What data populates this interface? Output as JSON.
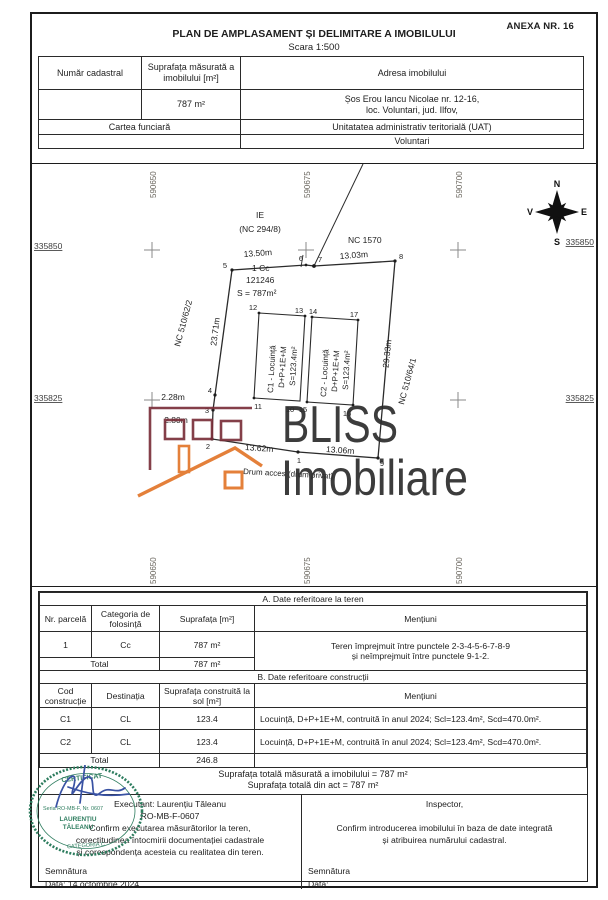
{
  "doc": {
    "annex": "ANEXA NR. 16",
    "title": "PLAN DE AMPLASAMENT ȘI DELIMITARE A IMOBILULUI",
    "scale": "Scara 1:500"
  },
  "header_table": {
    "numar_cadastral_label": "Număr cadastral",
    "suprafata_label": "Suprafața măsurată a imobilului [m²]",
    "adresa_label": "Adresa imobilului",
    "suprafata_value": "787 m²",
    "adresa_line1": "Șos Erou Iancu Nicolae nr. 12-16,",
    "adresa_line2": "loc. Voluntari, jud. Ilfov,",
    "cartea_funciara_label": "Cartea funciară",
    "uat_label": "Unitatatea administrativ teritorială (UAT)",
    "uat_value": "Voluntari"
  },
  "plan": {
    "grid_x_labels": {
      "g1": "590650",
      "g2": "590675",
      "g3": "590700"
    },
    "grid_y_labels": {
      "left_top": "335850",
      "left_bottom": "335825",
      "right_top": "335850",
      "right_bottom": "335825"
    },
    "compass": {
      "n": "N",
      "e": "E",
      "s": "S",
      "v": "V"
    },
    "neighbors": {
      "ie": "IE",
      "ie_nc": "(NC 294/8)",
      "nc_1570": "NC 1570",
      "nc_left": "NC 510/62/2",
      "nc_right": "NC 510/64/1"
    },
    "parcel": {
      "code": "1 Cc",
      "number": "121246",
      "area": "S = 787m²"
    },
    "road_label": "Drum acces (drum privat)",
    "dims": {
      "d56": "13.50m",
      "d78": "13.03m",
      "d89": "29.33m",
      "d45": "23.71m",
      "d34": "2.28m",
      "d23": "2.80m",
      "d21": "13.62m",
      "d19": "13.06m"
    },
    "buildings": {
      "c1_line1": "C1 - Locuință",
      "c1_line2": "D+P+1E+M",
      "c1_line3": "S=123.4m²",
      "c2_line1": "C2 - Locuință",
      "c2_line2": "D+P+1E+M",
      "c2_line3": "S=123.4m²"
    },
    "points": {
      "p1": "1",
      "p2": "2",
      "p3": "3",
      "p4": "4",
      "p5": "5",
      "p6": "6",
      "p7": "7",
      "p8": "8",
      "p9": "9",
      "p10": "10",
      "p11": "11",
      "p12": "12",
      "p13": "13",
      "p14": "14",
      "p15": "15",
      "p16": "16",
      "p17": "17"
    }
  },
  "watermark": {
    "line1": "BLISS",
    "line2": "Imobiliare"
  },
  "table_a": {
    "title": "A. Date referitoare la teren",
    "headers": {
      "col1": "Nr. parcelă",
      "col2": "Categoria de folosință",
      "col3": "Suprafața [m²]",
      "col4": "Mențiuni"
    },
    "row": {
      "nr": "1",
      "cat": "Cc",
      "sup": "787 m²"
    },
    "mentiuni_line1": "Teren împrejmuit între punctele 2-3-4-5-6-7-8-9",
    "mentiuni_line2": "și neîmprejmuit între punctele 9-1-2.",
    "total_label": "Total",
    "total_value": "787 m²"
  },
  "table_b": {
    "title": "B. Date referitoare construcții",
    "headers": {
      "col1": "Cod construcție",
      "col2": "Destinația",
      "col3": "Suprafața construită la sol [m²]",
      "col4": "Mențiuni"
    },
    "rows": [
      {
        "cod": "C1",
        "dest": "CL",
        "sup": "123.4",
        "mentiuni": "Locuință, D+P+1E+M, contruită în anul 2024; Scl=123.4m², Scd=470.0m²."
      },
      {
        "cod": "C2",
        "dest": "CL",
        "sup": "123.4",
        "mentiuni": "Locuință, D+P+1E+M, contruită în anul 2024; Scl=123.4m², Scd=470.0m²."
      }
    ],
    "total_label": "Total",
    "total_value": "246.8"
  },
  "totals": {
    "measured": "Suprafața totală măsurată a imobilului = 787 m²",
    "act": "Suprafața totală din act = 787 m²"
  },
  "signature": {
    "executant_line": "Executant: Laurențiu Tăleanu",
    "executant_cert": "RO-MB-F-0607",
    "confirm_line1": "Confirm executarea măsurătorilor la teren,",
    "confirm_line2": "corectitudinea întocmirii documentației cadastrale",
    "confirm_line3": "și corespondența acesteia cu realitatea din teren.",
    "semnatura_label": "Semnătura",
    "data_label": "Data: 14 octombrie 2024",
    "inspector_label": "Inspector,",
    "inspector_line1": "Confirm introducerea imobilului în baza de date integrată",
    "inspector_line2": "și atribuirea numărului cadastral.",
    "inspector_semnatura": "Semnătura",
    "inspector_data": "Data:"
  },
  "stamp": {
    "line1": "CERTIFICAT",
    "line2": "Seria RO-MB-F, Nr. 0607",
    "line3": "LAURENȚIU",
    "line4": "TĂLEANU",
    "line5": "CATEGORIA C"
  },
  "colors": {
    "logo_maroon": "#7a2f3a",
    "logo_orange": "#e2762a",
    "watermark_text": "#2c2c2c",
    "stamp_green": "#2e7d5f",
    "signature_blue": "#3952a3",
    "grid_gray": "#8a8a8a",
    "coord_label": "#6b675f"
  }
}
